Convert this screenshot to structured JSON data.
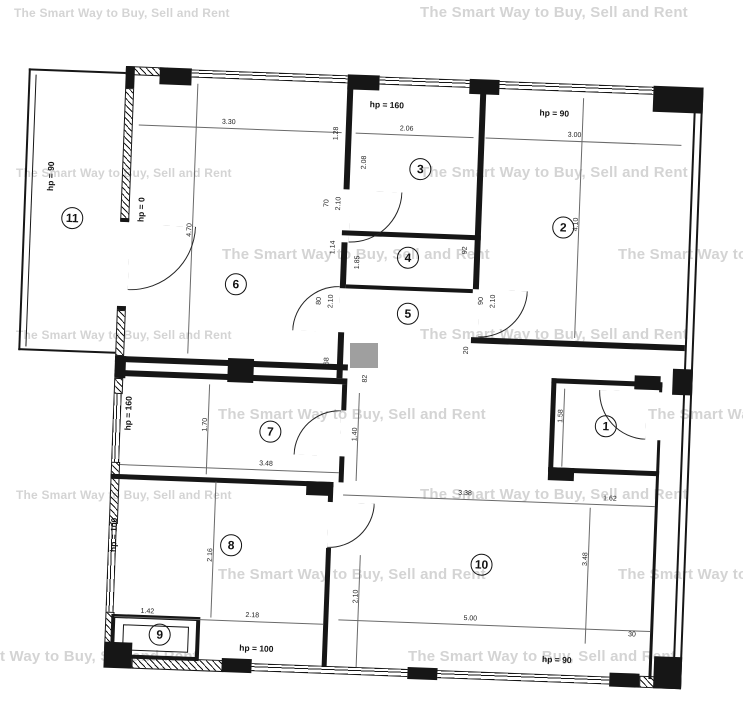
{
  "watermark": {
    "text": "The Smart Way to Buy, Sell and Rent"
  },
  "plan": {
    "rooms": {
      "r1": "1",
      "r2": "2",
      "r3": "3",
      "r4": "4",
      "r5": "5",
      "r6": "6",
      "r7": "7",
      "r8": "8",
      "r9": "9",
      "r10": "10",
      "r11": "11"
    },
    "hp": {
      "hp0": "hp = 0",
      "hp90": "hp = 90",
      "hp100": "hp = 100",
      "hp160": "hp = 160"
    },
    "dims": {
      "d330": "3.30",
      "d206": "2.06",
      "d300": "3.00",
      "d410": "4.10",
      "d470": "4.70",
      "d128": "1.28",
      "d208": "2.08",
      "d70": "70",
      "d210": "2.10",
      "d114": "1.14",
      "d80": "80",
      "d68": "68",
      "d92": "92",
      "d185": "1.85",
      "d90": "90",
      "d20": "20",
      "d82": "82",
      "d170": "1.70",
      "d348": "3.48",
      "d140": "1.40",
      "d158": "1.58",
      "d216": "2.16",
      "d142": "1.42",
      "d218": "2.18",
      "d338": "3.38",
      "d162": "1.62",
      "d500": "5.00",
      "d30": "30"
    }
  }
}
